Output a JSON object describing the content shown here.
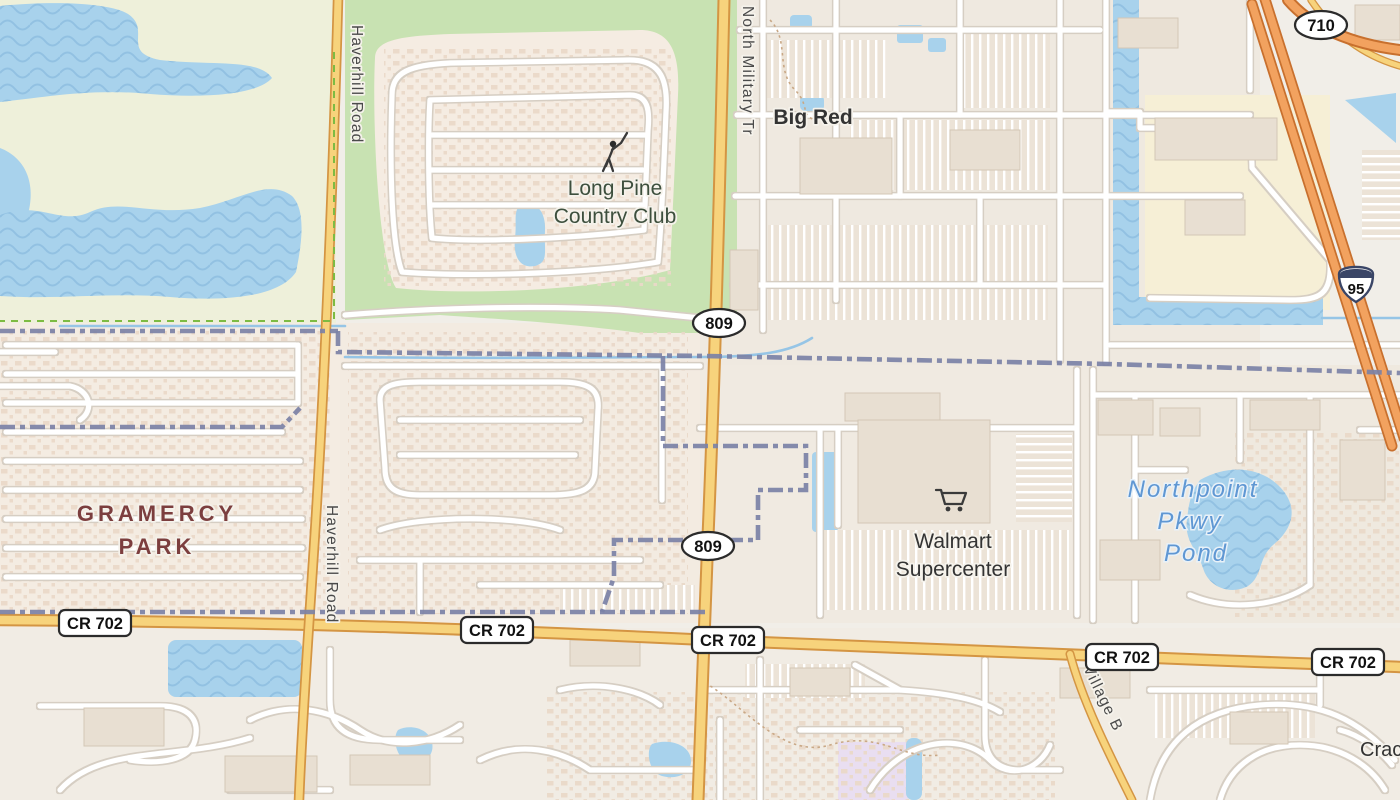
{
  "map_type": "street-map-tile-view",
  "colors": {
    "water": "#a8d2ec",
    "water_line": "#96c5e6",
    "land": "#f1eee8",
    "green_area": "#c8e2b2",
    "pale_green": "#eef0da",
    "cream": "#f6efd6",
    "purple_area": "#e9def1",
    "lot": "#ece3d7",
    "road_yellow": "#f7d37c",
    "road_yellow_casing": "#d49543",
    "road_orange": "#f2a25f",
    "road_orange_casing": "#c8702e",
    "street": "#ffffff",
    "street_casing": "#d6cec3",
    "boundary": "#7b81a6",
    "park_boundary": "#7dbb43",
    "building": "#e8dfd2",
    "building_stroke": "#d3c7b6",
    "label_dark": "#333333",
    "label_road": "#4a4a4a",
    "label_water": "#5f97d3",
    "label_place": "#7c3e3e",
    "label_green": "#3d4f3d",
    "shield_border": "#2b2b2b",
    "interstate_blue": "#3a4566"
  },
  "labels": {
    "places": {
      "big_red": "Big Red",
      "long_pine_1": "Long Pine",
      "long_pine_2": "Country Club",
      "gramercy_1": "GRAMERCY",
      "gramercy_2": "PARK",
      "walmart_1": "Walmart",
      "walmart_2": "Supercenter",
      "cracker_partial": "Crac"
    },
    "water": {
      "pond_1": "Northpoint",
      "pond_2": "Pkwy",
      "pond_3": "Pond"
    },
    "roads": {
      "haverhill": "Haverhill Road",
      "military": "North Military Tr",
      "village": "Village B"
    }
  },
  "shields": {
    "county": "CR 702",
    "state_809": "809",
    "state_710": "710",
    "interstate_95": "95"
  }
}
